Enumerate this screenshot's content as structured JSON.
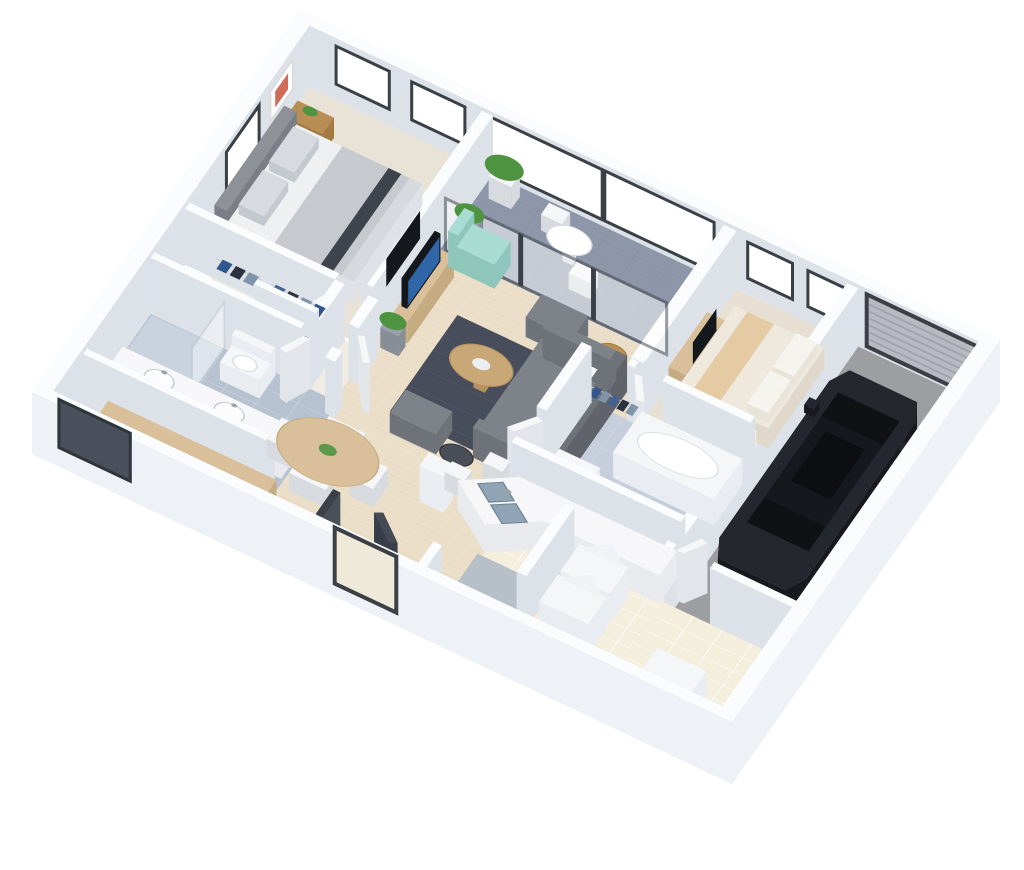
{
  "meta": {
    "description": "3D axonometric rendering of an apartment floor plan with attached garage",
    "background": "#ffffff"
  },
  "palette": {
    "bg": "#ffffff",
    "wallTop": "#fbfcfd",
    "wallSide": "#dde2e9",
    "wallSideNear": "#eef1f5",
    "frame": "#3b4046",
    "glass": "#ffffff",
    "carpet1": "#e9e2d6",
    "carpet2": "#e7dfd2",
    "wood": "#ecdfc9",
    "woodLine": "#dfd2b8",
    "hallFloor": "#f0ece3",
    "bathTile1": "#b7c2d0",
    "bathTile2": "#c6cedb",
    "grout": "#d3dce6",
    "showerTile": "#c9d3de",
    "balconyTile": "#8e97a9",
    "balconyLine": "#7d8698",
    "entryTile": "#8f97a7",
    "kitchenTile": "#f4eedd",
    "kGrout": "#ffffff",
    "garageFloor": "#9d9ea1",
    "white": "#f5f6f8",
    "softWhite": "#e9ecf0",
    "gray1": "#d7dbe0",
    "sofa": "#7e838a",
    "sofaDark": "#6e7379",
    "rug": "#474d5b",
    "rugLine": "#6a7183",
    "woodMid": "#c9a877",
    "woodLight": "#d9c09a",
    "woodDark": "#b98e55",
    "mint": "#a9dcd2",
    "mintDark": "#8fc6bb",
    "green": "#4e9440",
    "pot": "#9aa1a8",
    "bedWhite": "#eef0f2",
    "blanket": "#c6cacf",
    "stripe": "#3f444c",
    "headboard": "#8e9298",
    "cream": "#efe9dd",
    "runner": "#e4cba4",
    "car": "#24272d",
    "carSide": "#17191e",
    "carGlass": "#0f1115",
    "carRoof": "#15181d",
    "red": "#8e1f24",
    "roller": "#b7bac0",
    "rollerLine": "#9da1a8",
    "sinkBlue": "#8fa5b5",
    "sinkBlueDark": "#6d8494",
    "counter": "#f7f7f9",
    "counterSide": "#e8eaee",
    "stove": "#3a3f45",
    "grate": "#c8cdd2",
    "island": "#b7c0c9",
    "islandSide": "#a2abb5",
    "tvDark": "#14171c",
    "tvBlue": "#2e66a8",
    "artRed": "#c8503c",
    "doorLeaf": "#f6f7f9",
    "doorSide": "#e2e6eb",
    "darkDoor": "#454b55",
    "frontDoorGlass": "#efe9da",
    "bathWindow": "#49505c",
    "clothesA": "#32578f",
    "clothesB": "#2c3340",
    "clothesC": "#8094ab",
    "clothesD": "#dfe4ea",
    "clothesE": "#44618f"
  },
  "scene": {
    "rooms": [
      "master-bedroom",
      "walk-in-closet",
      "master-bathroom",
      "hallway",
      "living-room",
      "balcony",
      "dining-area",
      "entry",
      "kitchen",
      "bedroom-2",
      "bathroom-2",
      "garage",
      "laundry-room"
    ],
    "objects": [
      "master-bed",
      "nightstands",
      "wall-artwork",
      "bedroom-tv",
      "closet-clothes",
      "shower",
      "toilet",
      "double-sink-vanity",
      "dark-framed-window",
      "tv-console",
      "living-tv",
      "accent-chair",
      "sofa-sectional",
      "area-rug",
      "coffee-table",
      "ottomans",
      "side-tables",
      "potted-plants",
      "balcony-bistro-table",
      "balcony-chairs",
      "balcony-plant",
      "sliding-glass-doors",
      "dining-table",
      "dining-chairs",
      "sideboard",
      "display-pedestal",
      "entry-mirror",
      "front-door",
      "coat-closet",
      "kitchen-counter",
      "double-basin-sink",
      "bar-stools",
      "kitchen-island",
      "gas-cooktop",
      "washer",
      "dryer",
      "water-heater",
      "bed-2",
      "bed-bench",
      "dresser-with-tv",
      "bathtub",
      "vanity-2",
      "toilet-2",
      "sedan-car",
      "garage-roller-door",
      "windows"
    ]
  }
}
